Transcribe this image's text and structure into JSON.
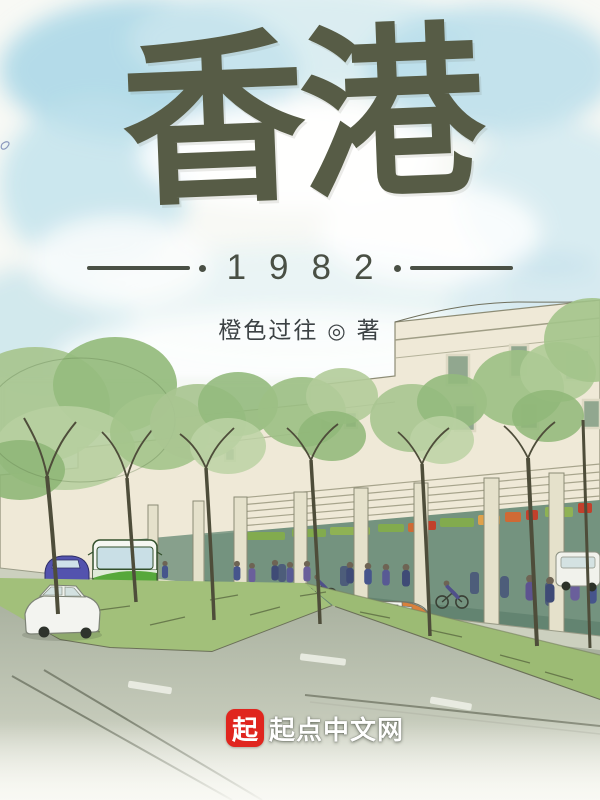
{
  "cover": {
    "title": "香港",
    "year": "1982",
    "author": "橙色过往",
    "author_separator": "◎",
    "author_role": "著"
  },
  "publisher": {
    "badge": "起",
    "name": "起点中文网"
  },
  "colors": {
    "title_ink": "#575c46",
    "year_ink": "#494f44",
    "author_ink": "#3c4244",
    "logo_red": "#e0251e",
    "logo_text": "#ffffff",
    "sky_blue": "#aed9e6",
    "tree_green": "#a9c691",
    "bus_green": "#57a83b",
    "building_cream": "#efe9d7",
    "grass_green": "#a2c07a",
    "road_gray": "#a9b19f"
  }
}
